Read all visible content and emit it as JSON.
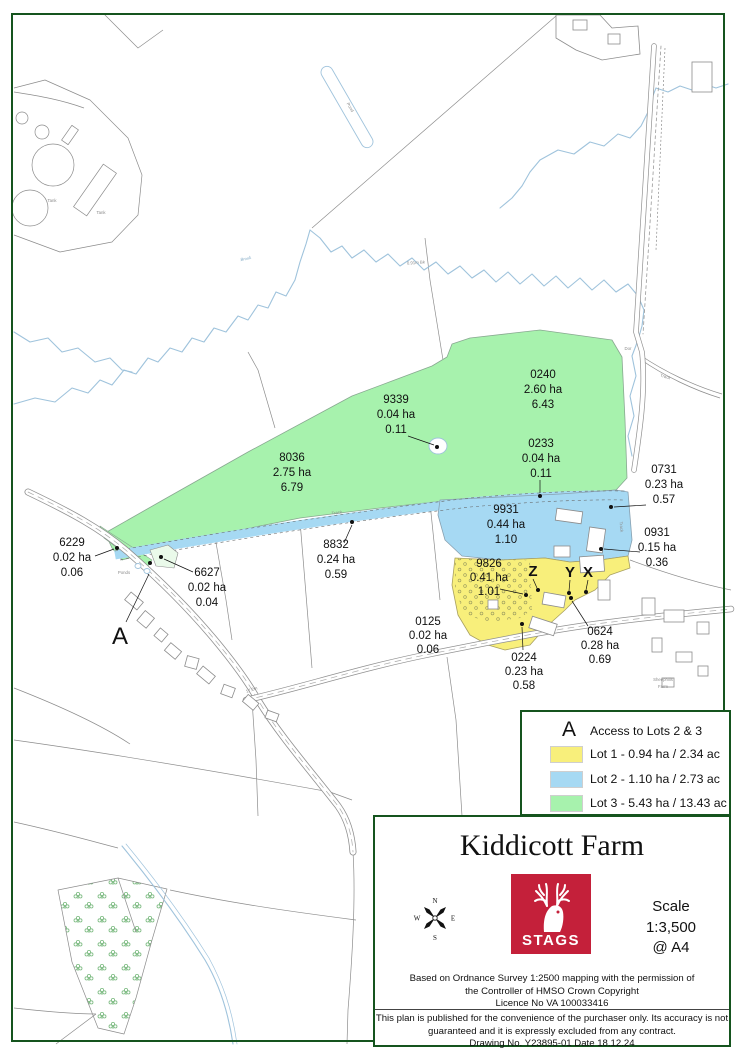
{
  "colors": {
    "page_border": "#15541e",
    "lot1_yellow": "#f8ef7b",
    "lot2_blue": "#a6d9f3",
    "lot3_green": "#a7f2ad",
    "stags_red": "#c4203a",
    "map_line_grey": "#8c8c8c",
    "stream_blue": "#9fc3dc"
  },
  "parcels": [
    {
      "id": "0240",
      "ha": "2.60 ha",
      "ac": "6.43"
    },
    {
      "id": "9339",
      "ha": "0.04 ha",
      "ac": "0.11"
    },
    {
      "id": "8036",
      "ha": "2.75 ha",
      "ac": "6.79"
    },
    {
      "id": "0233",
      "ha": "0.04 ha",
      "ac": "0.11"
    },
    {
      "id": "0731",
      "ha": "0.23 ha",
      "ac": "0.57"
    },
    {
      "id": "9931",
      "ha": "0.44 ha",
      "ac": "1.10"
    },
    {
      "id": "0931",
      "ha": "0.15 ha",
      "ac": "0.36"
    },
    {
      "id": "8832",
      "ha": "0.24 ha",
      "ac": "0.59"
    },
    {
      "id": "6229",
      "ha": "0.02 ha",
      "ac": "0.06"
    },
    {
      "id": "6627",
      "ha": "0.02 ha",
      "ac": "0.04"
    },
    {
      "id": "9826",
      "ha": "0.41 ha",
      "ac": "1.01"
    },
    {
      "id": "0125",
      "ha": "0.02 ha",
      "ac": "0.06"
    },
    {
      "id": "0224",
      "ha": "0.23 ha",
      "ac": "0.58"
    },
    {
      "id": "0624",
      "ha": "0.28 ha",
      "ac": "0.69"
    }
  ],
  "markers": [
    {
      "letter": "A"
    },
    {
      "letter": "Z"
    },
    {
      "letter": "Y"
    },
    {
      "letter": "X"
    }
  ],
  "tiny_labels": [
    {
      "t": "Tank"
    },
    {
      "t": "Tank"
    },
    {
      "t": "Pond"
    },
    {
      "t": "Ponds"
    },
    {
      "t": "Track"
    },
    {
      "t": "Track"
    },
    {
      "t": "Track"
    },
    {
      "t": "Dor"
    },
    {
      "t": "Brook"
    },
    {
      "t": "0.91m Bk"
    },
    {
      "t": "17.2m"
    },
    {
      "t": "Sheephills"
    },
    {
      "t": "Farm"
    }
  ],
  "legend": {
    "access_marker": "A",
    "access_label": "Access to Lots 2 & 3",
    "lots": [
      {
        "name": "Lot 1 - 0.94 ha / 2.34 ac",
        "color": "#f8ef7b"
      },
      {
        "name": "Lot 2 - 1.10 ha / 2.73 ac",
        "color": "#a6d9f3"
      },
      {
        "name": "Lot 3 - 5.43 ha / 13.43 ac",
        "color": "#a7f2ad"
      }
    ]
  },
  "title_block": {
    "title": "Kiddicott Farm",
    "logo_text": "STAGS",
    "scale_label": "Scale",
    "scale_value": "1:3,500",
    "scale_sheet": "@ A4",
    "attribution": [
      "Based on Ordnance Survey 1:2500 mapping with the permission of",
      "the Controller of HMSO      Crown Copyright",
      "Licence No VA 100033416"
    ],
    "disclaimer": [
      "This plan is published for the convenience of the purchaser only. Its accuracy is not",
      "guaranteed and it is expressly excluded from any contract.",
      "Drawing No. Y23895-01    Date 18.12.24"
    ]
  },
  "compass": {
    "n": "N",
    "e": "E",
    "s": "S",
    "w": "W"
  }
}
